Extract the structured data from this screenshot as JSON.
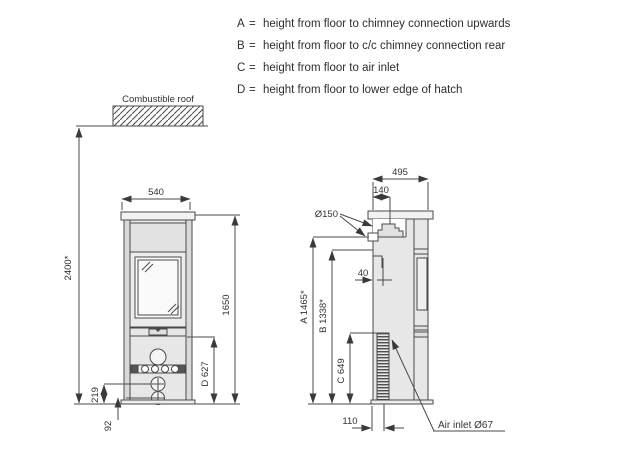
{
  "legend": {
    "separator": "=",
    "items": [
      {
        "key": "A",
        "text": "height from floor to chimney connection upwards"
      },
      {
        "key": "B",
        "text": "height from floor to c/c chimney connection rear"
      },
      {
        "key": "C",
        "text": "height from floor to air inlet"
      },
      {
        "key": "D",
        "text": "height from floor to lower edge of hatch"
      }
    ]
  },
  "front_view": {
    "roof_label": "Combustible roof",
    "dims": {
      "width": "540",
      "height_to_roof": "2400*",
      "height_total": "1650",
      "hatch_height": "D 627",
      "upper_knob_height": "219",
      "lower_knob_height": "92"
    }
  },
  "side_view": {
    "dims": {
      "depth": "495",
      "flue_center_offset": "140",
      "flue_diameter": "Ø150",
      "rear_connection_offset": "40",
      "a_height": "A 1465*",
      "b_height": "B 1338*",
      "c_height": "C 649",
      "air_inlet_offset": "110"
    },
    "air_inlet_label": "Air inlet Ø67"
  },
  "colors": {
    "line": "#4a4a4a",
    "body_fill": "#e7e7e7",
    "panel_fill": "#efefef",
    "glass_fill": "#fafafa",
    "dark_fill": "#555555",
    "text": "#333333",
    "background": "#ffffff"
  }
}
